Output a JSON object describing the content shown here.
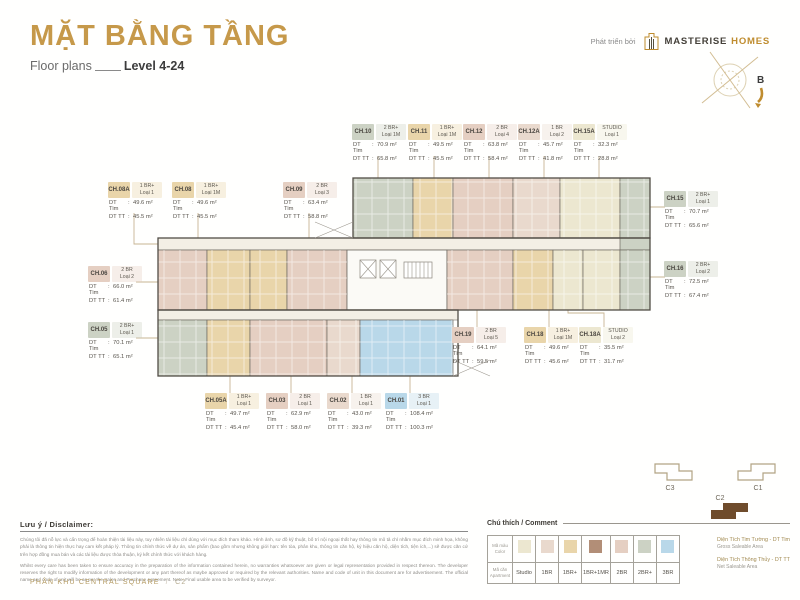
{
  "header": {
    "title": "MẶT BẰNG TẦNG",
    "subtitle_left": "Floor plans",
    "subtitle_right": "Level 4-24",
    "developer_label": "Phát triển bởi",
    "brand_name_primary": "MASTERISE",
    "brand_name_secondary": "HOMES",
    "compass_label": "B"
  },
  "colors": {
    "accent": "#c6994a",
    "studio": "#ece7d0",
    "br1": "#e9d9cd",
    "br1p": "#e9d5aa",
    "br1p1mr": "#b28e77",
    "br2": "#e5cfc2",
    "br2p": "#ccd2c4",
    "br3": "#b9d8e9",
    "keyplan_active": "#6f4c2c"
  },
  "callout_labels": {
    "tim": "DT Tim",
    "tt": "DT TT"
  },
  "units": [
    {
      "id": "CH.10",
      "type": "2 BR+",
      "variant": "Loại 1M",
      "tim": "70.9 m²",
      "tt": "65.8 m²",
      "color_key": "br2p"
    },
    {
      "id": "CH.11",
      "type": "1 BR+",
      "variant": "Loại 1M",
      "tim": "49.5 m²",
      "tt": "45.5 m²",
      "color_key": "br1p"
    },
    {
      "id": "CH.12",
      "type": "2 BR",
      "variant": "Loại 4",
      "tim": "63.8 m²",
      "tt": "58.4 m²",
      "color_key": "br2"
    },
    {
      "id": "CH.12A",
      "type": "1 BR",
      "variant": "Loại 2",
      "tim": "45.7 m²",
      "tt": "41.8 m²",
      "color_key": "br1"
    },
    {
      "id": "CH.15A",
      "type": "STUDIO",
      "variant": "Loại 1",
      "tim": "32.3 m²",
      "tt": "28.8 m²",
      "color_key": "studio"
    },
    {
      "id": "CH.08A",
      "type": "1 BR+",
      "variant": "Loại 1",
      "tim": "49.6 m²",
      "tt": "45.5 m²",
      "color_key": "br1p"
    },
    {
      "id": "CH.08",
      "type": "1 BR+",
      "variant": "Loại 1M",
      "tim": "49.6 m²",
      "tt": "45.5 m²",
      "color_key": "br1p"
    },
    {
      "id": "CH.09",
      "type": "2 BR",
      "variant": "Loại 3",
      "tim": "63.4 m²",
      "tt": "58.8 m²",
      "color_key": "br2"
    },
    {
      "id": "CH.15",
      "type": "2 BR+",
      "variant": "Loại 1",
      "tim": "70.7 m²",
      "tt": "65.6 m²",
      "color_key": "br2p"
    },
    {
      "id": "CH.16",
      "type": "2 BR+",
      "variant": "Loại 2",
      "tim": "72.5 m²",
      "tt": "67.4 m²",
      "color_key": "br2p"
    },
    {
      "id": "CH.06",
      "type": "2 BR",
      "variant": "Loại 2",
      "tim": "66.0 m²",
      "tt": "61.4 m²",
      "color_key": "br2"
    },
    {
      "id": "CH.05",
      "type": "2 BR+",
      "variant": "Loại 1",
      "tim": "70.1 m²",
      "tt": "65.1 m²",
      "color_key": "br2p"
    },
    {
      "id": "CH.19",
      "type": "2 BR",
      "variant": "Loại 5",
      "tim": "64.1 m²",
      "tt": "59.5 m²",
      "color_key": "br2"
    },
    {
      "id": "CH.18",
      "type": "1 BR+",
      "variant": "Loại 1M",
      "tim": "49.6 m²",
      "tt": "45.6 m²",
      "color_key": "br1p"
    },
    {
      "id": "CH.18A",
      "type": "STUDIO",
      "variant": "Loại 2",
      "tim": "35.5 m²",
      "tt": "31.7 m²",
      "color_key": "studio"
    },
    {
      "id": "CH.05A",
      "type": "1 BR+",
      "variant": "Loại 1",
      "tim": "49.7 m²",
      "tt": "45.4 m²",
      "color_key": "br1p"
    },
    {
      "id": "CH.03",
      "type": "2 BR",
      "variant": "Loại 1",
      "tim": "62.9 m²",
      "tt": "58.0 m²",
      "color_key": "br2"
    },
    {
      "id": "CH.02",
      "type": "1 BR",
      "variant": "Loại 1",
      "tim": "43.0 m²",
      "tt": "39.3 m²",
      "color_key": "br1"
    },
    {
      "id": "CH.01",
      "type": "3 BR",
      "variant": "Loại 1",
      "tim": "108.4 m²",
      "tt": "100.3 m²",
      "color_key": "br3"
    }
  ],
  "keyplan": {
    "buildings": [
      {
        "label": "C3"
      },
      {
        "label": "C1"
      },
      {
        "label": "C2"
      }
    ]
  },
  "legend": {
    "title": "Chú thích / Comment",
    "row1_label_vi": "Mã màu",
    "row1_label_en": "Color",
    "row2_label_vi": "Mã căn",
    "row2_label_en": "Apartment",
    "types": [
      {
        "label": "Studio",
        "color_key": "studio"
      },
      {
        "label": "1BR",
        "color_key": "br1"
      },
      {
        "label": "1BR+",
        "color_key": "br1p"
      },
      {
        "label": "1BR+1MR",
        "color_key": "br1p1mr"
      },
      {
        "label": "2BR",
        "color_key": "br2"
      },
      {
        "label": "2BR+",
        "color_key": "br2p"
      },
      {
        "label": "3BR",
        "color_key": "br3"
      }
    ],
    "notes": [
      {
        "vi": "Diện Tích Tim Tường - DT Tim",
        "en": "Gross Saleable Area"
      },
      {
        "vi": "Diện Tích Thông Thủy - DT TT",
        "en": "Net Saleable Area"
      }
    ]
  },
  "disclaimer": {
    "title": "Lưu ý / Disclaimer:",
    "text_vi": "Chúng tôi đã nỗ lực và cẩn trọng để hoàn thiện tài liệu này, tuy nhiên tài liệu chỉ dùng với mục đích tham khảo. Hình ảnh, sơ đồ kỹ thuật, bố trí nội ngoại thất hay thông tin mô tả chỉ nhằm mục đích minh họa, không phải là thông tin hiện thực hay cam kết pháp lý. Thông tin chính thức về dự án, sản phẩm (bao gồm nhưng không giới hạn: tên tòa, phân khu, thông tin căn hộ, ký hiệu căn hộ, diện tích, tiện ích,...) sẽ được căn cứ trên hợp đồng mua bán và các tài liệu được thỏa thuận, ký kết chính thức với khách hàng.",
    "text_en": "Whilst every care has been taken to ensure accuracy in the preparation of the information contained herein, no warranties whatsoever are given or legal representation provided in respect thereon. The developer reserves the right to modify information of the development or any part thereof as maybe approved or required by the relevant authorities. Name and code of unit in this document are for advertisement. The official name and code of unit will be as per the Sales and Purchase Agreement. Note: Final usable area to be verified by surveyor."
  },
  "footer": {
    "area": "PHÂN KHU CENTRAL SQUARE",
    "slash": "/",
    "block": "C2"
  }
}
